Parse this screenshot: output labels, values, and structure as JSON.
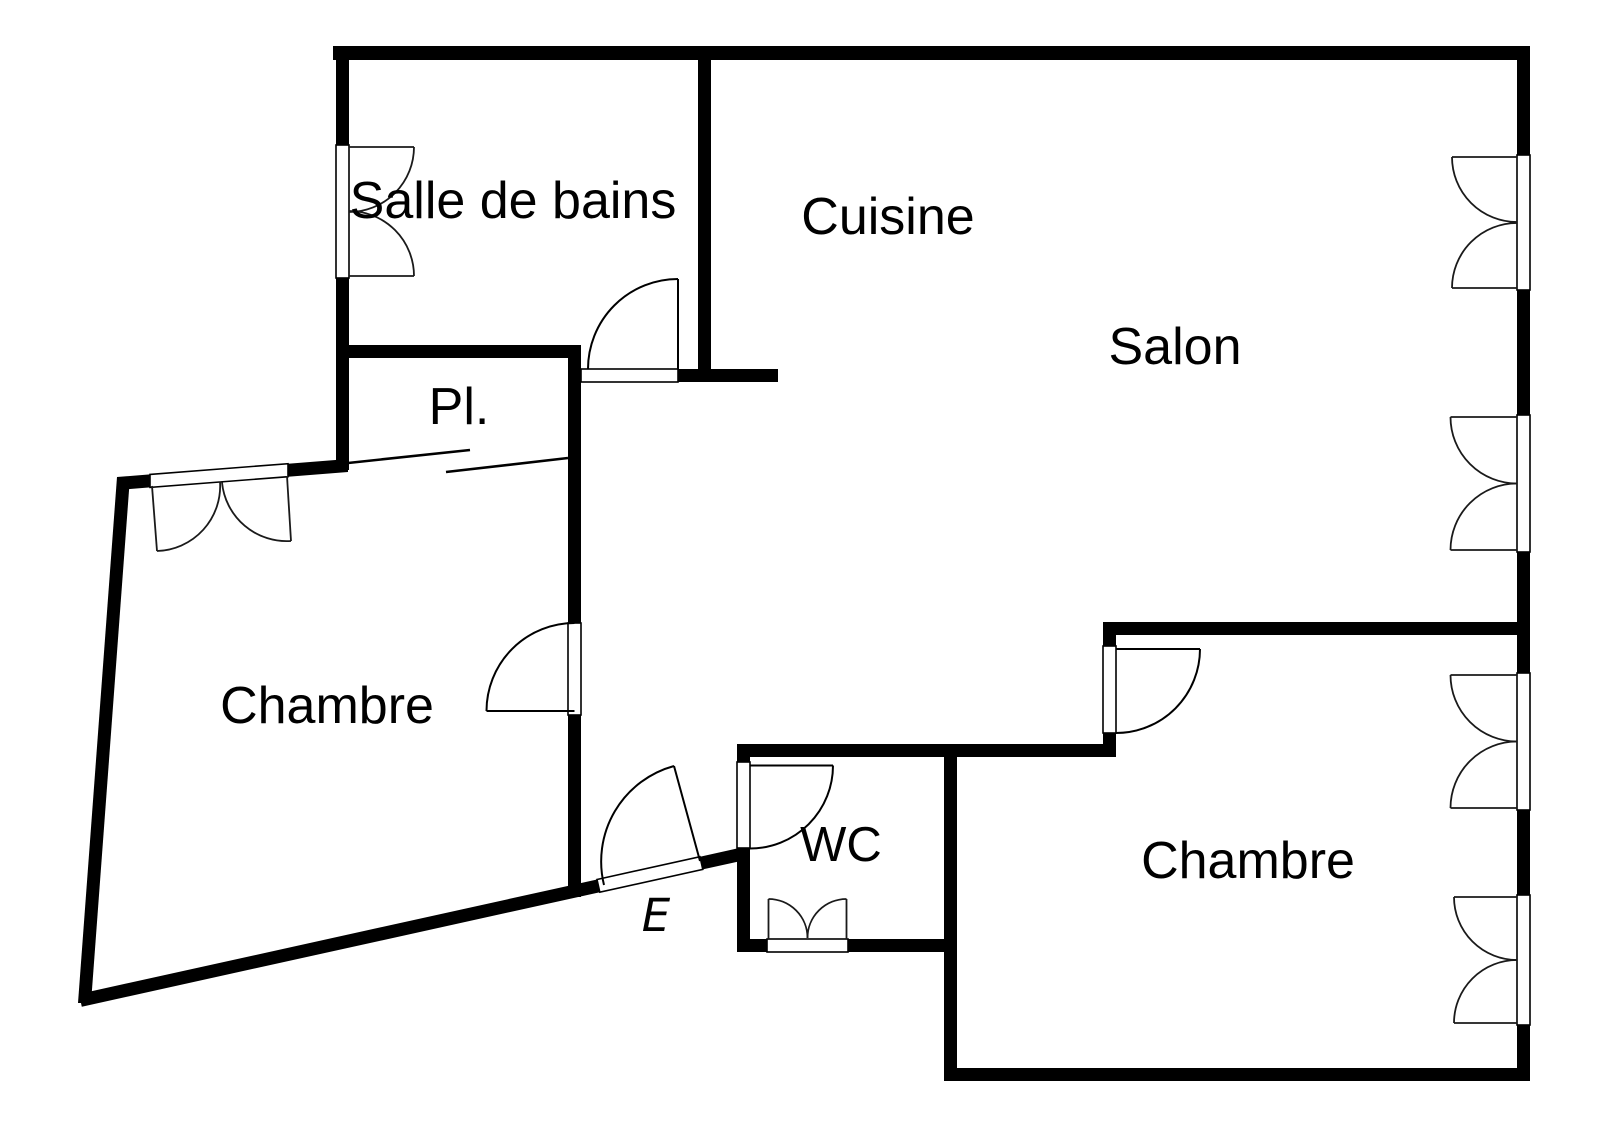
{
  "colors": {
    "background": "#ffffff",
    "walls": "#000000"
  },
  "plan": {
    "type": "apartment-floor-plan",
    "rooms": {
      "bathroom": {
        "label": "Salle de bains"
      },
      "kitchen": {
        "label": "Cuisine"
      },
      "living": {
        "label": "Salon"
      },
      "closet": {
        "label": "Pl."
      },
      "bedroom_left": {
        "label": "Chambre"
      },
      "bedroom_right": {
        "label": "Chambre"
      },
      "wc": {
        "label": "WC"
      },
      "entrance": {
        "label": "E"
      }
    }
  }
}
